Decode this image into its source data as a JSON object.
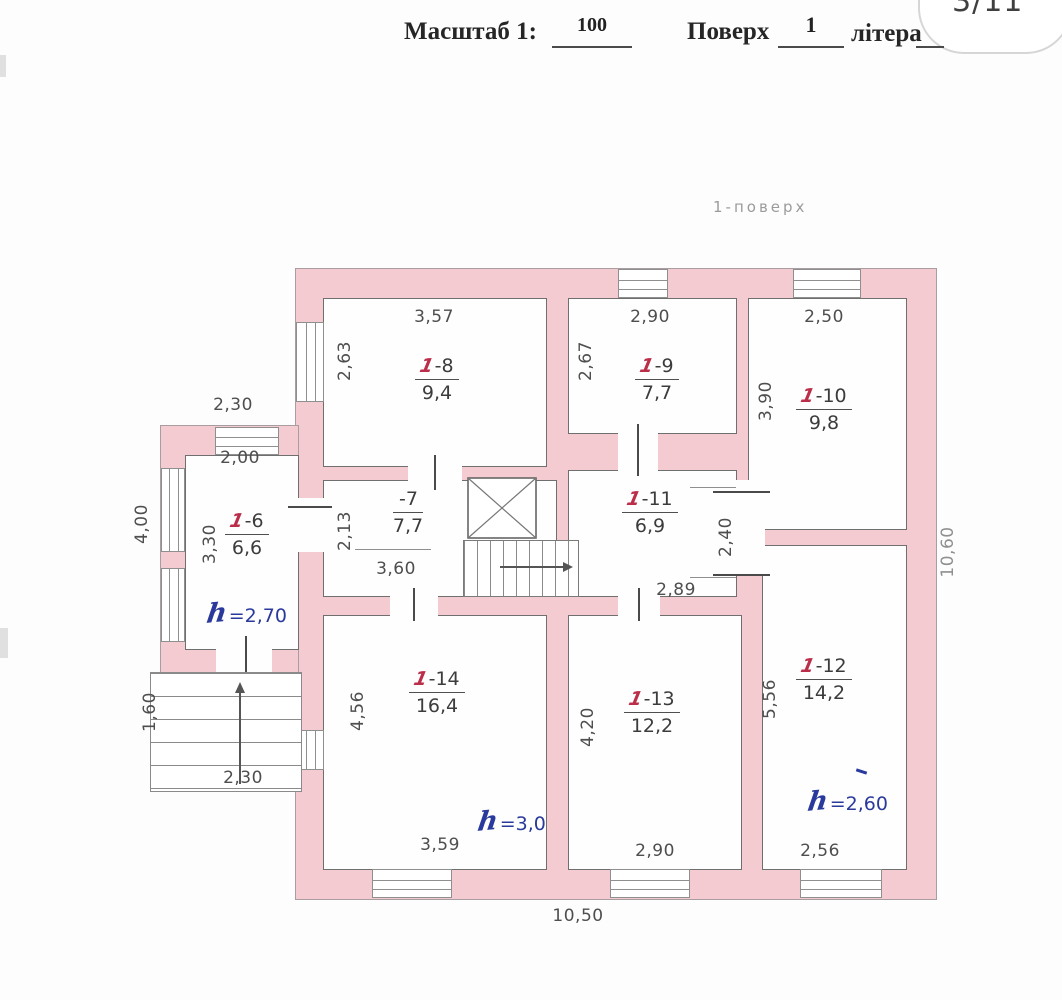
{
  "page": {
    "corner_indicator": "3/11"
  },
  "header": {
    "scale_label": "Масштаб 1:",
    "scale_value": "100",
    "floor_label": "Поверх",
    "floor_value": "1",
    "letter_label": "літера",
    "letter_value": ""
  },
  "plan": {
    "caption": "1-поверх",
    "rooms": {
      "r6": {
        "prefix": "1",
        "suffix": "-6",
        "area": "6,6"
      },
      "r7": {
        "prefix": "",
        "suffix": "-7",
        "area": "7,7"
      },
      "r8": {
        "prefix": "1",
        "suffix": "-8",
        "area": "9,4"
      },
      "r9": {
        "prefix": "1",
        "suffix": "-9",
        "area": "7,7"
      },
      "r10": {
        "prefix": "1",
        "suffix": "-10",
        "area": "9,8"
      },
      "r11": {
        "prefix": "1",
        "suffix": "-11",
        "area": "6,9"
      },
      "r12": {
        "prefix": "1",
        "suffix": "-12",
        "area": "14,2"
      },
      "r13": {
        "prefix": "1",
        "suffix": "-13",
        "area": "12,2"
      },
      "r14": {
        "prefix": "1",
        "suffix": "-14",
        "area": "16,4"
      }
    },
    "heights": {
      "r6": {
        "sym": "h",
        "val": "=2,70"
      },
      "r14": {
        "sym": "h",
        "val": "=3,0"
      },
      "r12": {
        "sym": "h",
        "val": "=2,60"
      }
    },
    "dims": {
      "room8_w": "3,57",
      "room8_h": "2,63",
      "room9_w": "2,90",
      "room9_h": "2,67",
      "room10_w": "2,50",
      "room10_h": "3,90",
      "annex_top": "2,30",
      "room6_w": "2,00",
      "room6_h": "3,30",
      "room7_h": "2,13",
      "room7_w": "3,60",
      "room11_h": "2,40",
      "room11_w": "2,89",
      "room14_h": "4,56",
      "room14_w": "3,59",
      "room13_h": "4,20",
      "room13_w": "2,90",
      "room12_h": "5,56",
      "room12_w": "2,56",
      "left_height": "4,00",
      "porch_height": "1,60",
      "porch_width": "2,30",
      "right_height": "10,60",
      "bottom_width": "10,50"
    },
    "colors": {
      "wall_fill": "#f5cbd2",
      "room_number_accent": "#bb2e49",
      "height_ink": "#2a3a9c"
    }
  }
}
